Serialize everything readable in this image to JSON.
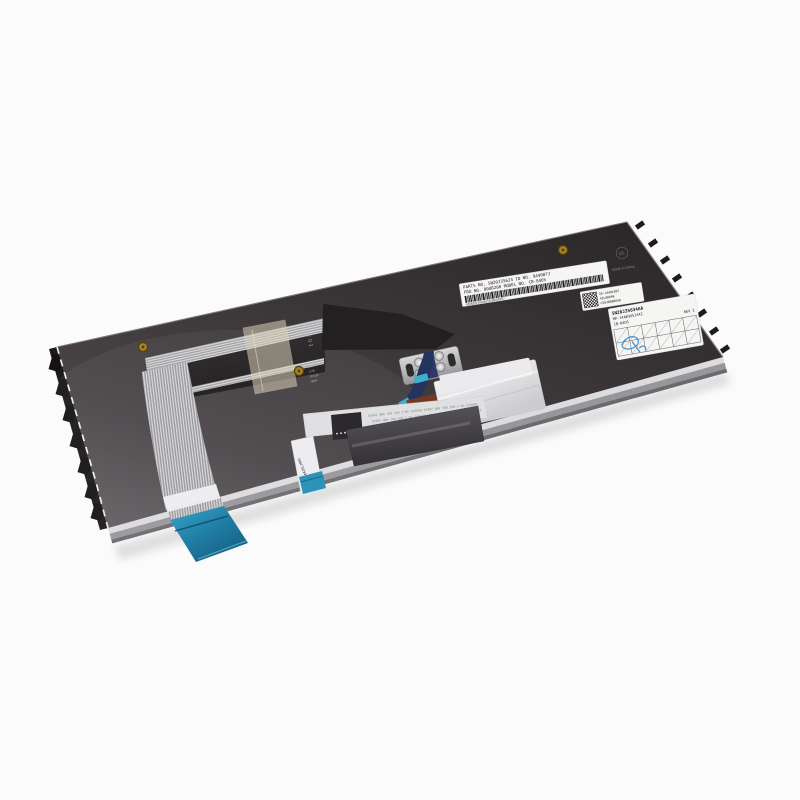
{
  "scene": {
    "subject": "Rear side of a black laptop replacement keyboard with ribbon cables, photographed at an angle on a white background",
    "background_color": "#fbfbfb"
  },
  "colors": {
    "panel_dark": "#2e2a2c",
    "panel_light": "#5f5a5d",
    "connector_blue": "#2b93b8",
    "tape_beige": "#d8cfb6",
    "kapton_brown": "#7a3a1e",
    "kapton_dark": "#5f2d18",
    "brass": "#b9902f",
    "label_white": "#f5f5f4",
    "stamp_blue": "#2e86c4"
  },
  "labels": {
    "barcode_label": {
      "line1": "PARTS NO. SN20J35624   ID NO. 9A9007J",
      "line2": "FRU NO.  00UR200    MODEL NO. CB-84US",
      "number": "8SSN20J35624E1SS08450077"
    },
    "qr_label": {
      "line1": "SD-1A40LR07",
      "line2": "4ZL0B09K",
      "line3": "C003N88B05B"
    },
    "rev_label": {
      "line1": "SN20J35634AA",
      "line2": "MP-14AB3USJ442",
      "line3": "CB-84US",
      "rev": "REV 2"
    },
    "ul_mark": "UL",
    "made_in": "Made in China"
  },
  "prints": {
    "c01": "C01",
    "rows": [
      "0B5",
      "C7B",
      "2P133",
      "9W8"
    ]
  },
  "cables": {
    "awm_text": "E66643 VW-1 60V 80C AWM 20624  E66643 VW-1 60V 80C AWM 20624",
    "small_ribbon_text": "0B0-L91A4JELJ001"
  }
}
